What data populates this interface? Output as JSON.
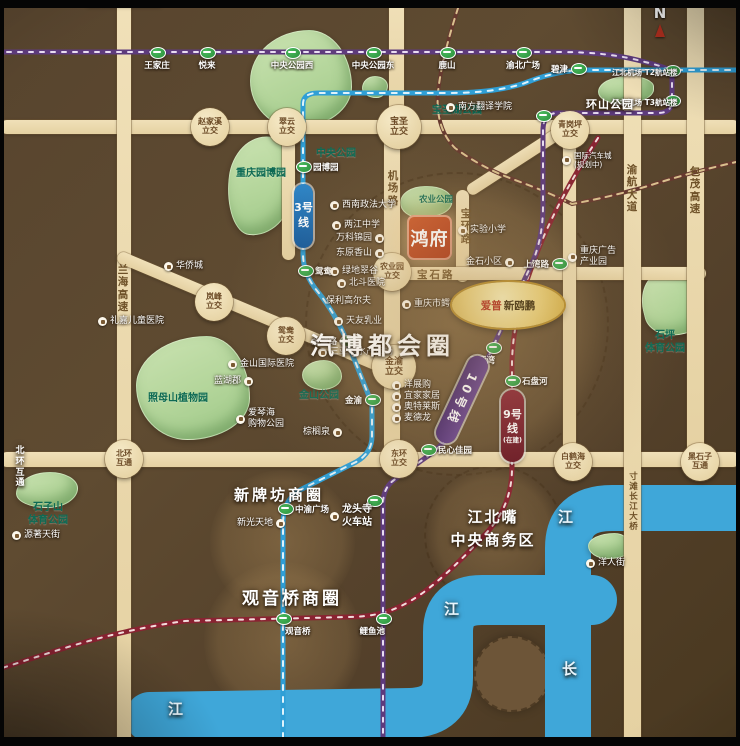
{
  "compass": {
    "label": "N"
  },
  "logo": {
    "text": "鸿府"
  },
  "gold_badge": {
    "brand": "爱普",
    "name": "新鸥鹏"
  },
  "badges": {
    "line3": "3号线",
    "line10": "10号线",
    "line9": "9号线",
    "line9_sub": "(在建)"
  },
  "colors": {
    "road": "#e9d6aa",
    "river": "#3fa7d9",
    "line3": "#2f9fd6",
    "line10": "#5e3b7d",
    "line9": "#8a2332",
    "railway": "#66392f",
    "park": "#b9d8a2",
    "gold": "#e8c96a",
    "logo_bg": "#c24e24"
  },
  "lines": {
    "line3": {
      "d": "M 283 750 L 283 524 Q 283 500 300 490 L 356 462 Q 372 453 372 436 L 372 404 L 349 346 Q 336 314 318 292 Q 303 274 303 254 L 303 104 Q 303 93 318 93 L 448 93 Q 495 93 525 83 Q 552 72 580 70 L 745 70"
    },
    "line10a": {
      "d": "M -4 52 L 560 52 Q 610 52 645 62 Q 662 66 670 70"
    },
    "line10b": {
      "d": "M 672 72 L 672 100 Q 672 113 658 113 L 558 113 Q 543 113 543 130 L 543 206 Q 543 243 528 272 L 470 396 Q 452 440 428 456 L 394 480 Q 383 488 383 504 L 383 750"
    },
    "line9": {
      "d": "M 598 138 Q 553 207 532 266 Q 513 318 512 362 L 512 468 Q 512 504 489 530 Q 453 570 424 592 Q 402 608 382 613 Q 366 617 348 617 L 185 621 Q 120 630 52 652 L -4 670"
    },
    "railway": {
      "d": "M 462 -4 Q 442 55 438 92 Q 435 128 455 148 Q 482 168 515 180 Q 548 192 572 204 Q 610 197 648 186 Q 695 171 745 160"
    },
    "river_main": {
      "d": "M 748 508 L 612 508 Q 568 508 568 548 L 568 750"
    },
    "river_lower": {
      "d": "M 592 600 L 482 600 Q 448 600 448 632 L 448 678 Q 448 712 410 713 L 150 717"
    }
  },
  "zones": [
    {
      "cls": "dashed",
      "css": {
        "left": "305px",
        "top": "172px",
        "width": "300px",
        "height": "300px"
      }
    },
    {
      "cls": "",
      "css": {
        "left": "210px",
        "top": "470px",
        "width": "145px",
        "height": "145px"
      }
    },
    {
      "cls": "",
      "css": {
        "left": "204px",
        "top": "562px",
        "width": "158px",
        "height": "158px"
      }
    },
    {
      "cls": "dashed",
      "css": {
        "left": "424px",
        "top": "465px",
        "width": "136px",
        "height": "136px"
      }
    },
    {
      "cls": "solid",
      "css": {
        "left": "474px",
        "top": "636px",
        "width": "72px",
        "height": "72px"
      }
    }
  ],
  "parks": [
    {
      "css": {
        "left": "250px",
        "top": "30px",
        "width": "100px",
        "height": "96px",
        "borderRadius": "58% 42% 55% 45% / 52% 58% 42% 48%"
      }
    },
    {
      "css": {
        "left": "362px",
        "top": "76px",
        "width": "24px",
        "height": "20px",
        "borderRadius": "50% 50% 45% 55% / 55% 45% 55% 45%"
      }
    },
    {
      "css": {
        "left": "228px",
        "top": "136px",
        "width": "64px",
        "height": "98px",
        "borderRadius": "55% 45% 60% 40% / 45% 52% 48% 55%",
        "transform": "rotate(6deg)"
      }
    },
    {
      "css": {
        "left": "136px",
        "top": "336px",
        "width": "112px",
        "height": "102px",
        "borderRadius": "62% 38% 55% 45% / 48% 60% 40% 52%"
      }
    },
    {
      "css": {
        "left": "16px",
        "top": "472px",
        "width": "60px",
        "height": "34px",
        "borderRadius": "55% 45% 50% 50% / 60% 45% 55% 40%"
      }
    },
    {
      "css": {
        "left": "642px",
        "top": "270px",
        "width": "58px",
        "height": "64px",
        "borderRadius": "45% 55% 40% 60% / 55% 45% 60% 40%",
        "transform": "rotate(-14deg)"
      }
    },
    {
      "css": {
        "left": "588px",
        "top": "533px",
        "width": "42px",
        "height": "24px",
        "borderRadius": "60% 40% 55% 45% / 50% 60% 40% 50%"
      }
    },
    {
      "css": {
        "left": "598px",
        "top": "76px",
        "width": "54px",
        "height": "26px",
        "borderRadius": "55% 45% 60% 40% / 60% 40% 55% 45%"
      }
    },
    {
      "css": {
        "left": "302px",
        "top": "360px",
        "width": "38px",
        "height": "28px",
        "borderRadius": "55% 45% 50% 50% / 50% 55% 45% 50%"
      }
    },
    {
      "css": {
        "left": "400px",
        "top": "186px",
        "width": "50px",
        "height": "30px",
        "borderRadius": "50% 50% 60% 40% / 55% 45% 50% 50%"
      }
    }
  ],
  "park_labels": [
    {
      "label": "中央公园",
      "cls": "",
      "css": {
        "left": "316px",
        "top": "148px"
      }
    },
    {
      "label": "重庆园博园",
      "cls": "",
      "css": {
        "left": "236px",
        "top": "168px"
      }
    },
    {
      "label": "宝圣湖公园",
      "cls": "",
      "css": {
        "left": "432px",
        "top": "105px"
      }
    },
    {
      "label": "照母山植物园",
      "cls": "",
      "css": {
        "left": "148px",
        "top": "393px"
      }
    },
    {
      "label": "石子山\n体育公园",
      "cls": "",
      "css": {
        "left": "28px",
        "top": "502px"
      }
    },
    {
      "label": "石坪\n体育公园",
      "cls": "",
      "css": {
        "left": "645px",
        "top": "330px"
      }
    },
    {
      "label": "金山公园",
      "cls": "",
      "css": {
        "left": "299px",
        "top": "390px"
      }
    },
    {
      "label": "农业公园",
      "cls": "sm",
      "css": {
        "left": "419px",
        "top": "195px"
      }
    }
  ],
  "roads": [
    {
      "css": {
        "left": "0px",
        "top": "120px",
        "width": "740px",
        "height": "14px"
      }
    },
    {
      "css": {
        "left": "117px",
        "top": "0px",
        "width": "14px",
        "height": "746px"
      }
    },
    {
      "css": {
        "left": "384px",
        "top": "121px",
        "width": "16px",
        "height": "346px"
      }
    },
    {
      "css": {
        "left": "468px",
        "top": "186px",
        "width": "114px",
        "height": "12px",
        "transform": "rotate(-33deg)",
        "transformOrigin": "0 50%"
      }
    },
    {
      "css": {
        "left": "456px",
        "top": "190px",
        "width": "13px",
        "height": "92px"
      }
    },
    {
      "css": {
        "left": "384px",
        "top": "267px",
        "width": "322px",
        "height": "13px"
      }
    },
    {
      "css": {
        "left": "0px",
        "top": "452px",
        "width": "740px",
        "height": "15px"
      }
    },
    {
      "css": {
        "left": "563px",
        "top": "128px",
        "width": "13px",
        "height": "336px"
      }
    },
    {
      "css": {
        "left": "624px",
        "top": "0px",
        "width": "17px",
        "height": "746px"
      }
    },
    {
      "css": {
        "left": "687px",
        "top": "0px",
        "width": "17px",
        "height": "466px"
      }
    },
    {
      "css": {
        "left": "389px",
        "top": "0px",
        "width": "15px",
        "height": "128px"
      }
    },
    {
      "css": {
        "left": "282px",
        "top": "128px",
        "width": "13px",
        "height": "132px",
        "borderRadius": "0 0 8px 8px"
      }
    },
    {
      "css": {
        "left": "118px",
        "top": "250px",
        "width": "303px",
        "height": "12px",
        "transform": "rotate(22.8deg)",
        "transformOrigin": "0 50%"
      }
    },
    {
      "css": {
        "left": "86px",
        "top": "0px",
        "width": "76px",
        "height": "7px"
      }
    }
  ],
  "road_labels": [
    {
      "label": "兰海高速",
      "cls": "v",
      "css": {
        "left": "116px",
        "top": "264px"
      }
    },
    {
      "label": "机场路",
      "cls": "v",
      "css": {
        "left": "386px",
        "top": "170px"
      }
    },
    {
      "label": "宝环路",
      "cls": "v",
      "css": {
        "left": "459px",
        "top": "208px"
      }
    },
    {
      "label": "宝石路",
      "cls": "h",
      "css": {
        "left": "417px",
        "top": "269px"
      }
    },
    {
      "label": "渝航大道",
      "cls": "v",
      "css": {
        "left": "625px",
        "top": "164px"
      }
    },
    {
      "label": "包茂高速",
      "cls": "v",
      "css": {
        "left": "688px",
        "top": "166px"
      }
    },
    {
      "label": "寸滩长江大桥",
      "cls": "smv",
      "css": {
        "left": "626px",
        "top": "472px"
      }
    }
  ],
  "interchanges": [
    {
      "label": "赵家溪\n立交",
      "cls": "",
      "css": {
        "left": "210px",
        "top": "127px"
      }
    },
    {
      "label": "翠云\n立交",
      "cls": "",
      "css": {
        "left": "287px",
        "top": "127px"
      }
    },
    {
      "label": "宝圣\n立交",
      "cls": "big",
      "css": {
        "left": "399px",
        "top": "127px"
      }
    },
    {
      "label": "青岗坪\n立交",
      "cls": "",
      "css": {
        "left": "570px",
        "top": "130px"
      }
    },
    {
      "label": "岚峰\n立交",
      "cls": "",
      "css": {
        "left": "214px",
        "top": "302px"
      }
    },
    {
      "label": "鸳鸯\n立交",
      "cls": "",
      "css": {
        "left": "286px",
        "top": "336px"
      }
    },
    {
      "label": "金渝\n立交",
      "cls": "big",
      "css": {
        "left": "394px",
        "top": "367px"
      }
    },
    {
      "label": "农业园\n立交",
      "cls": "",
      "css": {
        "left": "392px",
        "top": "272px"
      }
    },
    {
      "label": "东环\n立交",
      "cls": "",
      "css": {
        "left": "399px",
        "top": "459px"
      }
    },
    {
      "label": "北环\n互通",
      "cls": "",
      "css": {
        "left": "124px",
        "top": "459px"
      }
    },
    {
      "label": "白鹤海\n立交",
      "cls": "",
      "css": {
        "left": "573px",
        "top": "462px"
      }
    },
    {
      "label": "黑石子\n互通",
      "cls": "",
      "css": {
        "left": "700px",
        "top": "462px"
      }
    }
  ],
  "stations": [
    {
      "label": "王家庄",
      "cls": "lbl-below",
      "css": {
        "left": "157px",
        "top": "52px"
      }
    },
    {
      "label": "悦来",
      "cls": "lbl-below",
      "css": {
        "left": "207px",
        "top": "52px"
      }
    },
    {
      "label": "中央公园西",
      "cls": "lbl-below",
      "css": {
        "left": "292px",
        "top": "52px"
      }
    },
    {
      "label": "中央公园东",
      "cls": "lbl-below",
      "css": {
        "left": "373px",
        "top": "52px"
      }
    },
    {
      "label": "鹿山",
      "cls": "lbl-below",
      "css": {
        "left": "447px",
        "top": "52px"
      }
    },
    {
      "label": "渝北广场",
      "cls": "lbl-below",
      "css": {
        "left": "523px",
        "top": "52px"
      }
    },
    {
      "label": "碧津",
      "cls": "lbl-left",
      "css": {
        "left": "578px",
        "top": "68px"
      }
    },
    {
      "label": "江北机场\nT2航站楼",
      "cls": "lbl-left two",
      "css": {
        "left": "672px",
        "top": "70px"
      }
    },
    {
      "label": "江北机场\nT3航站楼",
      "cls": "lbl-left two",
      "css": {
        "left": "672px",
        "top": "100px"
      }
    },
    {
      "label": "",
      "cls": "lbl-below",
      "css": {
        "left": "543px",
        "top": "115px"
      }
    },
    {
      "label": "园博园",
      "cls": "lbl-right",
      "css": {
        "left": "303px",
        "top": "166px"
      }
    },
    {
      "label": "鸳鸯",
      "cls": "lbl-right",
      "css": {
        "left": "305px",
        "top": "270px"
      }
    },
    {
      "label": "金童路",
      "cls": "lbl-left",
      "css": {
        "left": "347px",
        "top": "340px"
      }
    },
    {
      "label": "金渝",
      "cls": "lbl-left",
      "css": {
        "left": "372px",
        "top": "399px"
      }
    },
    {
      "label": "上湾路",
      "cls": "lbl-left",
      "css": {
        "left": "559px",
        "top": "263px"
      }
    },
    {
      "label": "三亚湾",
      "cls": "lbl-bl",
      "css": {
        "left": "493px",
        "top": "347px"
      }
    },
    {
      "label": "石盘河",
      "cls": "lbl-right",
      "css": {
        "left": "512px",
        "top": "380px"
      }
    },
    {
      "label": "民心佳园",
      "cls": "lbl-right",
      "css": {
        "left": "428px",
        "top": "449px"
      }
    },
    {
      "label": "中渝广场",
      "cls": "lbl-right",
      "css": {
        "left": "285px",
        "top": "508px"
      }
    },
    {
      "label": "",
      "cls": "lbl-below",
      "css": {
        "left": "374px",
        "top": "500px"
      }
    },
    {
      "label": "观音桥",
      "cls": "lbl-br",
      "css": {
        "left": "283px",
        "top": "618px"
      }
    },
    {
      "label": "鲤鱼池",
      "cls": "lbl-bl",
      "css": {
        "left": "383px",
        "top": "618px"
      }
    }
  ],
  "pois": [
    {
      "label": "西南政法大学",
      "cls": "",
      "css": {
        "left": "330px",
        "top": "200px"
      }
    },
    {
      "label": "两江中学",
      "cls": "",
      "css": {
        "left": "332px",
        "top": "220px"
      }
    },
    {
      "label": "万科锦园",
      "cls": "ir",
      "css": {
        "left": "336px",
        "top": "233px"
      }
    },
    {
      "label": "东原香山",
      "cls": "ir",
      "css": {
        "left": "336px",
        "top": "248px"
      }
    },
    {
      "label": "绿地翠谷",
      "cls": "",
      "css": {
        "left": "330px",
        "top": "266px"
      }
    },
    {
      "label": "北斗医院",
      "cls": "",
      "css": {
        "left": "337px",
        "top": "278px"
      }
    },
    {
      "label": "保利高尔夫",
      "cls": "noico",
      "css": {
        "left": "326px",
        "top": "296px"
      }
    },
    {
      "label": "礼嘉儿童医院",
      "cls": "",
      "css": {
        "left": "98px",
        "top": "316px"
      }
    },
    {
      "label": "金山国际医院",
      "cls": "",
      "css": {
        "left": "228px",
        "top": "359px"
      }
    },
    {
      "label": "蓝湖郡",
      "cls": "ir",
      "css": {
        "left": "214px",
        "top": "376px"
      }
    },
    {
      "label": "爱琴海\n购物公园",
      "cls": "",
      "css": {
        "left": "236px",
        "top": "408px"
      }
    },
    {
      "label": "华侨城",
      "cls": "",
      "css": {
        "left": "164px",
        "top": "261px"
      }
    },
    {
      "label": "棕榈泉",
      "cls": "ir",
      "css": {
        "left": "303px",
        "top": "427px"
      }
    },
    {
      "label": "实验小学",
      "cls": "",
      "css": {
        "left": "458px",
        "top": "225px"
      }
    },
    {
      "label": "金石小区",
      "cls": "ir",
      "css": {
        "left": "466px",
        "top": "257px"
      }
    },
    {
      "label": "重庆广告\n产业园",
      "cls": "",
      "css": {
        "left": "568px",
        "top": "246px"
      }
    },
    {
      "label": "国际汽车城\n(规划中)",
      "cls": "sm",
      "css": {
        "left": "562px",
        "top": "151px"
      }
    },
    {
      "label": "南方翻译学院",
      "cls": "",
      "css": {
        "left": "446px",
        "top": "102px"
      }
    },
    {
      "label": "重庆市鳄鱼中心",
      "cls": "",
      "css": {
        "left": "402px",
        "top": "299px"
      }
    },
    {
      "label": "天友乳业",
      "cls": "",
      "css": {
        "left": "334px",
        "top": "316px"
      }
    },
    {
      "label": "三亚湾水产市场",
      "cls": "",
      "css": {
        "left": "318px",
        "top": "347px"
      }
    },
    {
      "label": "洋展购",
      "cls": "",
      "css": {
        "left": "392px",
        "top": "380px"
      }
    },
    {
      "label": "宜家家居",
      "cls": "",
      "css": {
        "left": "392px",
        "top": "391px"
      }
    },
    {
      "label": "奥特莱斯",
      "cls": "",
      "css": {
        "left": "392px",
        "top": "402px"
      }
    },
    {
      "label": "麦德龙",
      "cls": "",
      "css": {
        "left": "392px",
        "top": "413px"
      }
    },
    {
      "label": "新光天地",
      "cls": "ir",
      "css": {
        "left": "237px",
        "top": "518px"
      }
    },
    {
      "label": "龙头寺\n火车站",
      "cls": "bold2",
      "css": {
        "left": "330px",
        "top": "504px"
      }
    },
    {
      "label": "源著天街",
      "cls": "",
      "css": {
        "left": "12px",
        "top": "530px"
      }
    },
    {
      "label": "洋人街",
      "cls": "",
      "css": {
        "left": "586px",
        "top": "558px"
      }
    }
  ],
  "big_labels": [
    {
      "label": "汽博都会圈",
      "cls": "xl",
      "css": {
        "left": "310px",
        "top": "326px"
      }
    },
    {
      "label": "新牌坊商圈",
      "cls": "lg",
      "css": {
        "left": "234px",
        "top": "484px"
      }
    },
    {
      "label": "观音桥商圈",
      "cls": "lg2",
      "css": {
        "left": "242px",
        "top": "584px"
      }
    },
    {
      "label": "江北嘴\n中央商务区",
      "cls": "cbd",
      "css": {
        "left": "428px",
        "top": "506px",
        "width": "130px"
      }
    },
    {
      "label": "环山公园",
      "cls": "md",
      "css": {
        "left": "586px",
        "top": "96px"
      }
    },
    {
      "label": "江",
      "cls": "river",
      "css": {
        "left": "558px",
        "top": "506px"
      }
    },
    {
      "label": "江",
      "cls": "river",
      "css": {
        "left": "444px",
        "top": "598px"
      }
    },
    {
      "label": "长",
      "cls": "river",
      "css": {
        "left": "562px",
        "top": "658px"
      }
    },
    {
      "label": "江",
      "cls": "river",
      "css": {
        "left": "168px",
        "top": "698px"
      }
    },
    {
      "label": "北环互通",
      "cls": "edge",
      "css": {
        "left": "14px",
        "top": "446px"
      }
    }
  ]
}
